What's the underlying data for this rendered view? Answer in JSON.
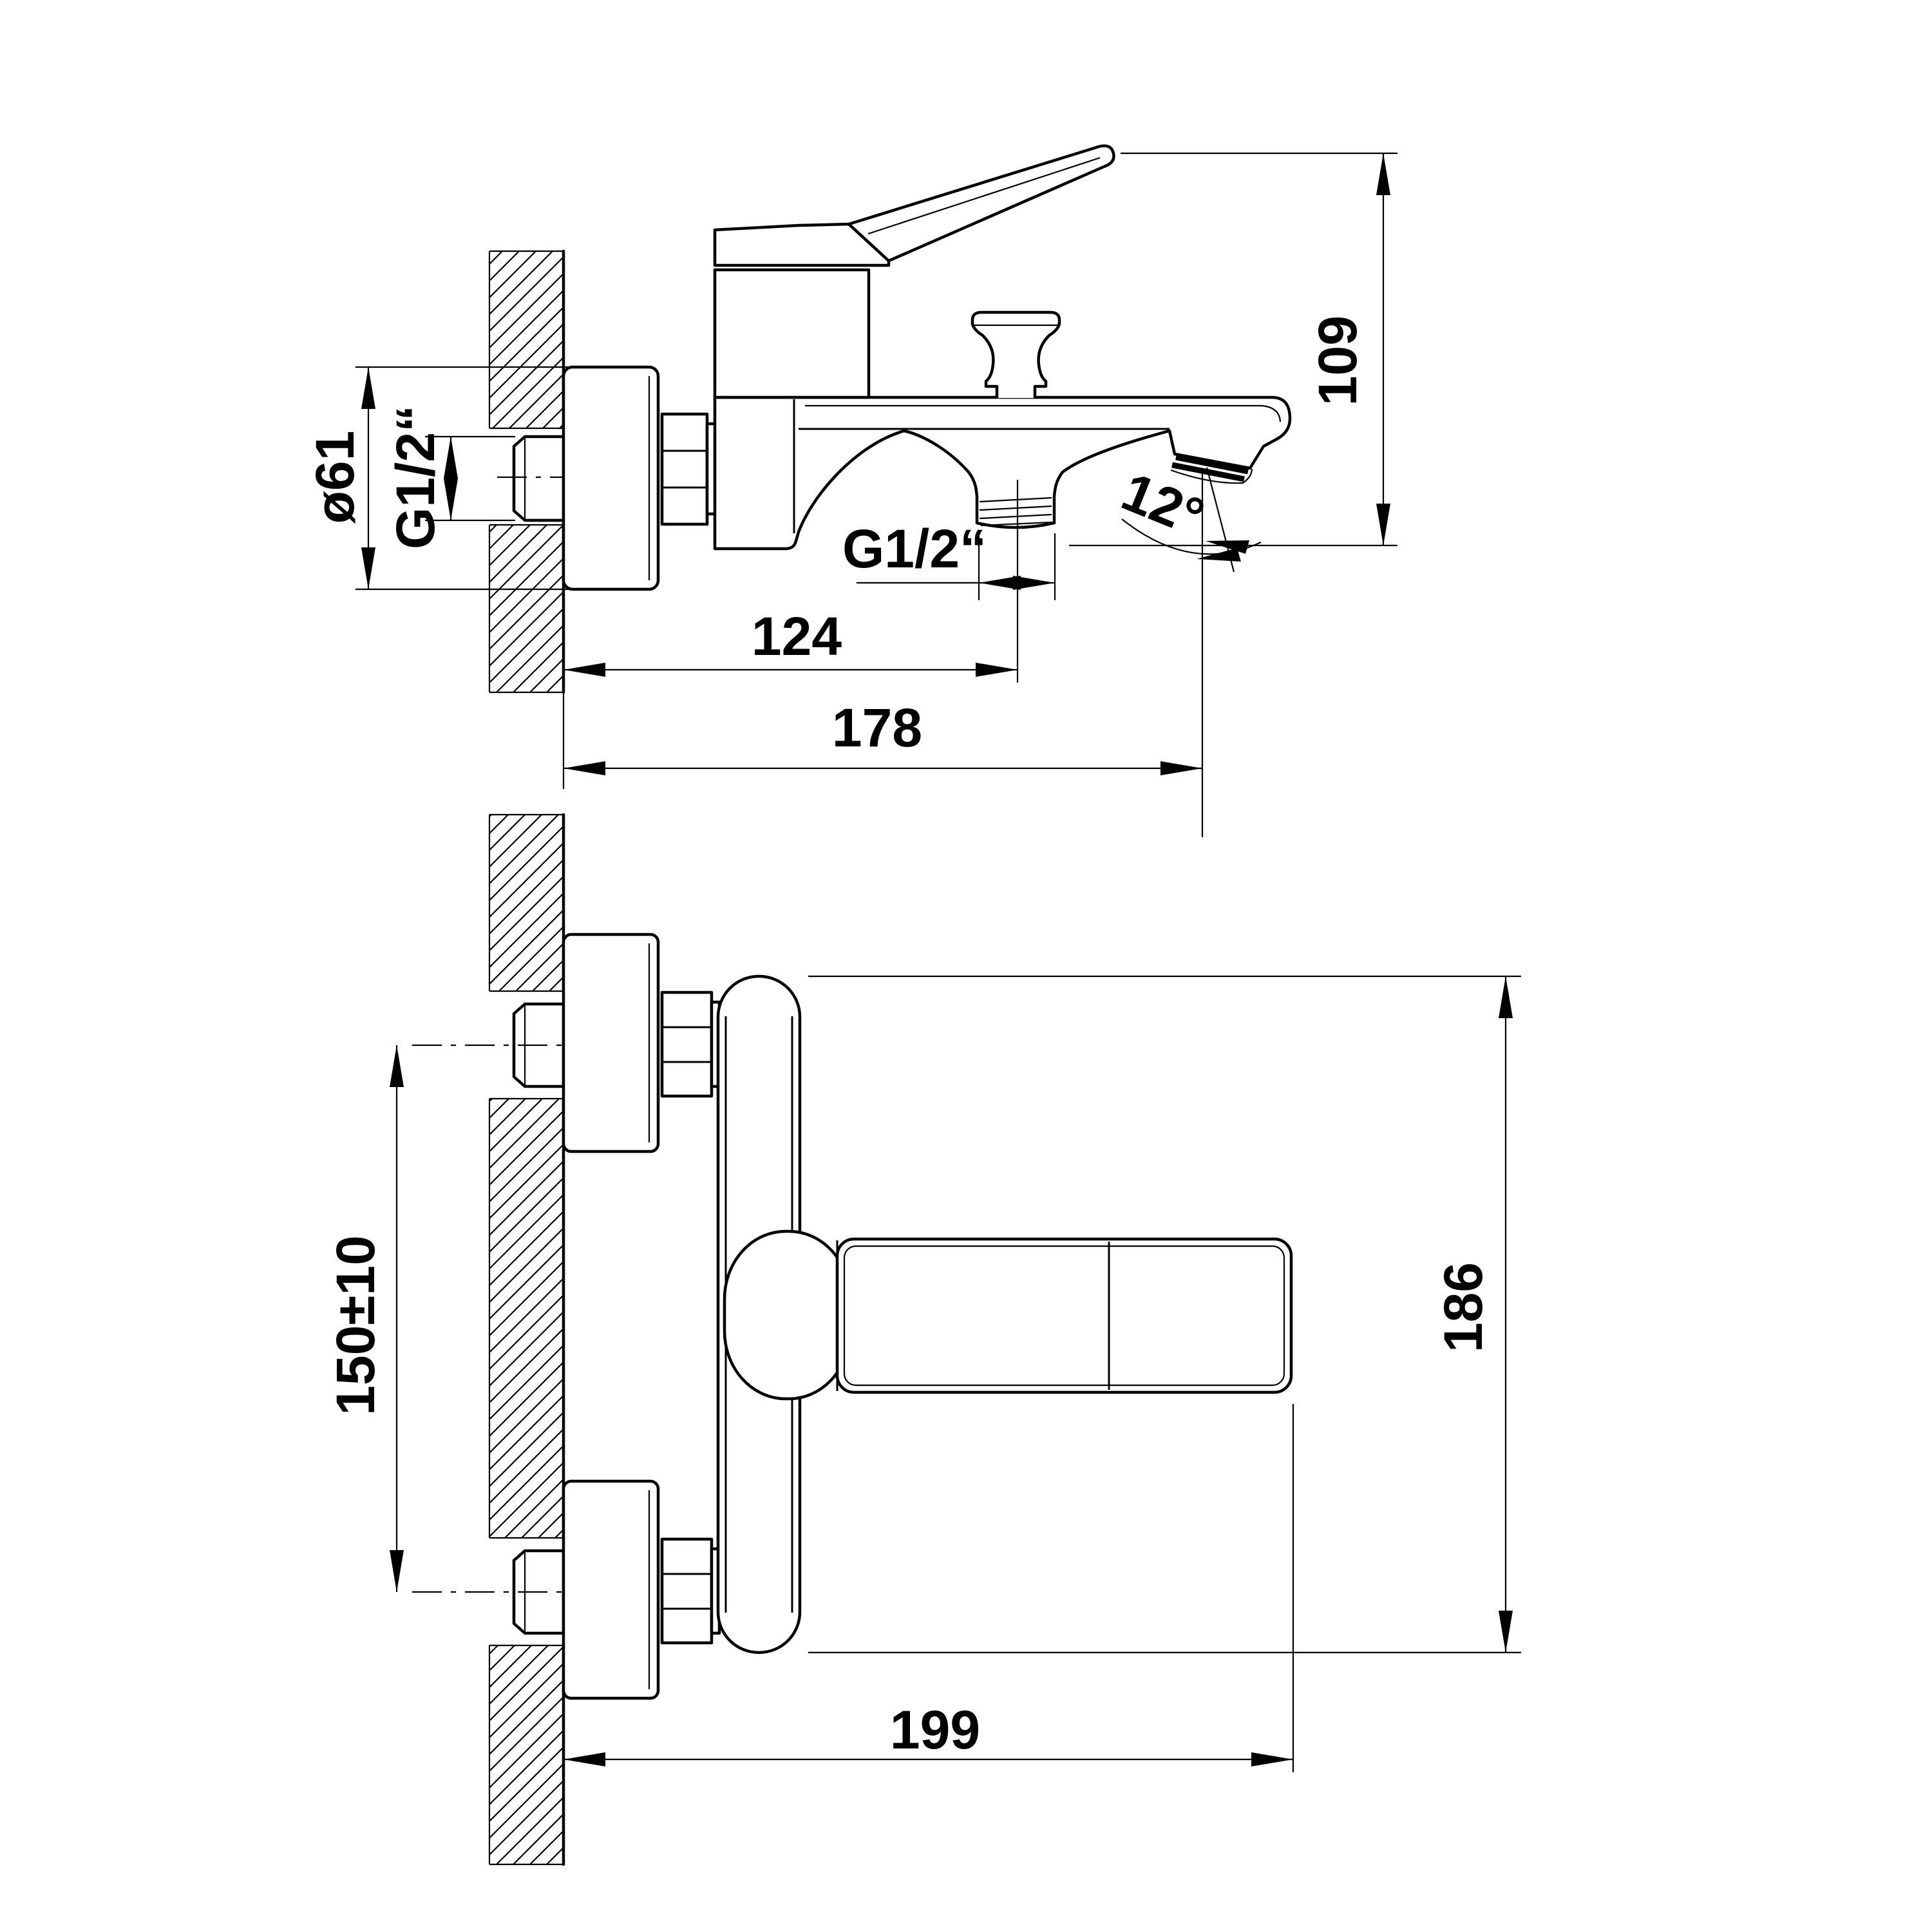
{
  "drawing": {
    "kind": "bath-mixer installation drawing",
    "side_view": {
      "dim_escutcheon_diameter": "ø61",
      "dim_wall_thread": "G1/2“",
      "dim_height": "109",
      "dim_spout_angle": "12°",
      "dim_shower_thread": "G1/2“",
      "dim_to_shower_outlet": "124",
      "dim_to_spout_tip": "178"
    },
    "plan_view": {
      "dim_connection_centers": "150±10",
      "dim_body_length": "186",
      "dim_total_projection": "199"
    },
    "style": {
      "line_color": "#000000",
      "background": "#ffffff"
    }
  }
}
